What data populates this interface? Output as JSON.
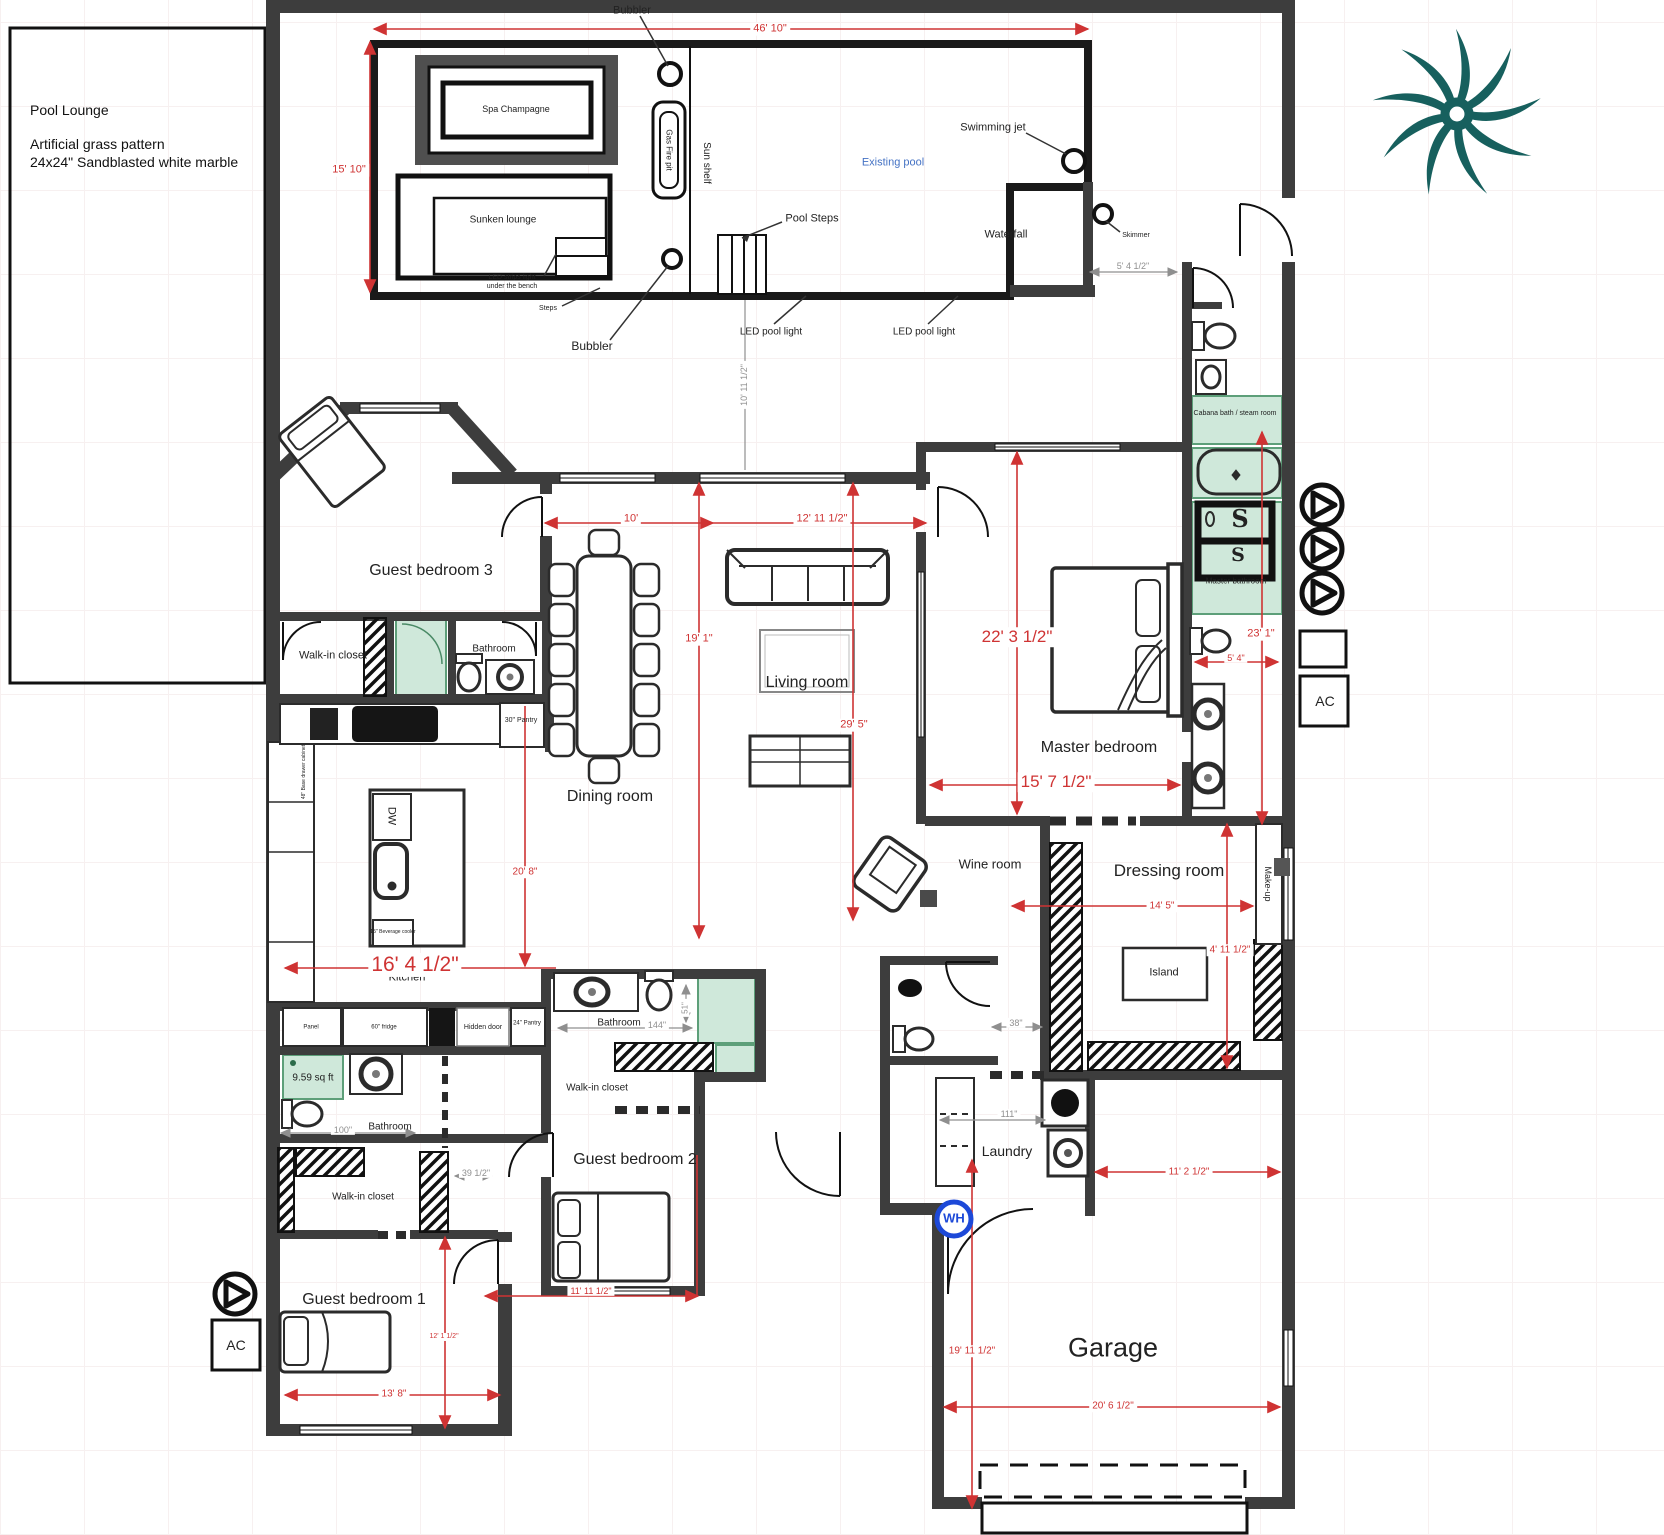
{
  "notes": {
    "title": "Pool Lounge",
    "line1": "Artificial grass pattern",
    "line2": "24x24\" Sandblasted white marble"
  },
  "pool": {
    "bubbler_top": "Bubbler",
    "bubbler_bottom": "Bubbler",
    "spa": "Spa Champagne",
    "gas_fire_pit": "Gas Fire pit",
    "sun_shelf": "Sun shelf",
    "sunken_lounge": "Sunken lounge",
    "led_strips_1": "LED strips light",
    "led_strips_2": "under the bench",
    "steps": "Steps",
    "pool_steps": "Pool Steps",
    "swimming_jet": "Swimming jet",
    "existing_pool": "Existing pool",
    "waterfall": "Waterfall",
    "skimmer": "Skimmer",
    "led_light_left": "LED pool light",
    "led_light_right": "LED pool light"
  },
  "rooms": {
    "guest3": "Guest bedroom 3",
    "closet3": "Walk-in closet",
    "bath3": "Bathroom",
    "dining": "Dining room",
    "living": "Living room",
    "master": "Master bedroom",
    "cabana": "Cabana bath / steam room",
    "master_bath": "Master bathroom",
    "wine": "Wine room",
    "dressing": "Dressing room",
    "kitchen": "Kitchen",
    "bath_k": "Bathroom",
    "closet_k": "Walk-in closet",
    "guest1": "Guest bedroom 1",
    "bath2": "Bathroom",
    "closet2": "Walk-in closet",
    "guest2": "Guest bedroom 2",
    "laundry": "Laundry",
    "garage": "Garage"
  },
  "fixtures": {
    "island": "Island",
    "make_up": "Make-up",
    "dw": "DW",
    "wh": "WH",
    "ac": "AC",
    "shower_s": "S",
    "pantry30": "30\" Pantry",
    "pantry24": "24\" Pantry",
    "fridge": "60\" fridge",
    "panel": "Panel",
    "hidden_door": "Hidden door",
    "shower_area": "9.59 sq ft",
    "bev_cooler": "15\" Beverage cooler",
    "base_cab": "48\" Base drawer cabinet"
  },
  "dims_red": {
    "d46_10": "46' 10\"",
    "d15_10": "15' 10\"",
    "d10": "10'",
    "d12_11": "12' 11 1/2\"",
    "d19_1": "19' 1\"",
    "d29_5": "29' 5\"",
    "d22_3": "22' 3 1/2\"",
    "d15_7": "15' 7 1/2\"",
    "d23_1": "23' 1\"",
    "d5_4": "5' 4\"",
    "d16_4": "16' 4 1/2\"",
    "d20_8": "20' 8\"",
    "d14_5": "14' 5\"",
    "d4_11": "4' 11 1/2\"",
    "d11_2": "11' 2 1/2\"",
    "d11_11": "11' 11 1/2\"",
    "d13_8": "13' 8\"",
    "d12_1": "12' 1 1/2\"",
    "d19_11": "19' 11 1/2\"",
    "d20_6": "20' 6 1/2\""
  },
  "dims_gray": {
    "d5_4h": "5' 4 1/2\"",
    "d10_11": "10' 11 1/2\"",
    "d100": "100\"",
    "d39": "39 1/2\"",
    "d111": "111\"",
    "d38": "38\"",
    "d144": "144\"",
    "d51": "51\""
  },
  "colors": {
    "wall": "#3d3d3d",
    "dimension_red": "#cf3333",
    "room_green": "#cfe8da",
    "pool_text_blue": "#4472c4",
    "water_heater_blue": "#1d49d8",
    "palm_teal": "#17605e"
  }
}
